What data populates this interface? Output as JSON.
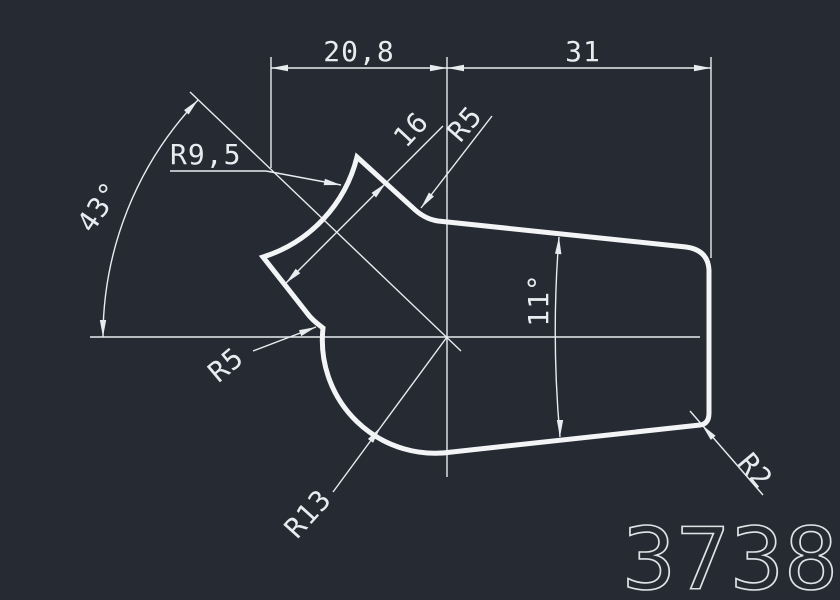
{
  "canvas": {
    "background_color": "#262a33",
    "line_color": "#e9ecef",
    "outline_color": "#f2f4f6"
  },
  "labels": {
    "dim_top_left": "20,8",
    "dim_top_right": "31",
    "dim_spike_width": "16",
    "radius_top_corner": "R5",
    "radius_concave": "R9,5",
    "angle_left": "43°",
    "angle_taper": "11°",
    "radius_notch": "R5",
    "radius_bottom_arc": "R13",
    "radius_right_corner": "R2",
    "drawing_number": "3738"
  }
}
